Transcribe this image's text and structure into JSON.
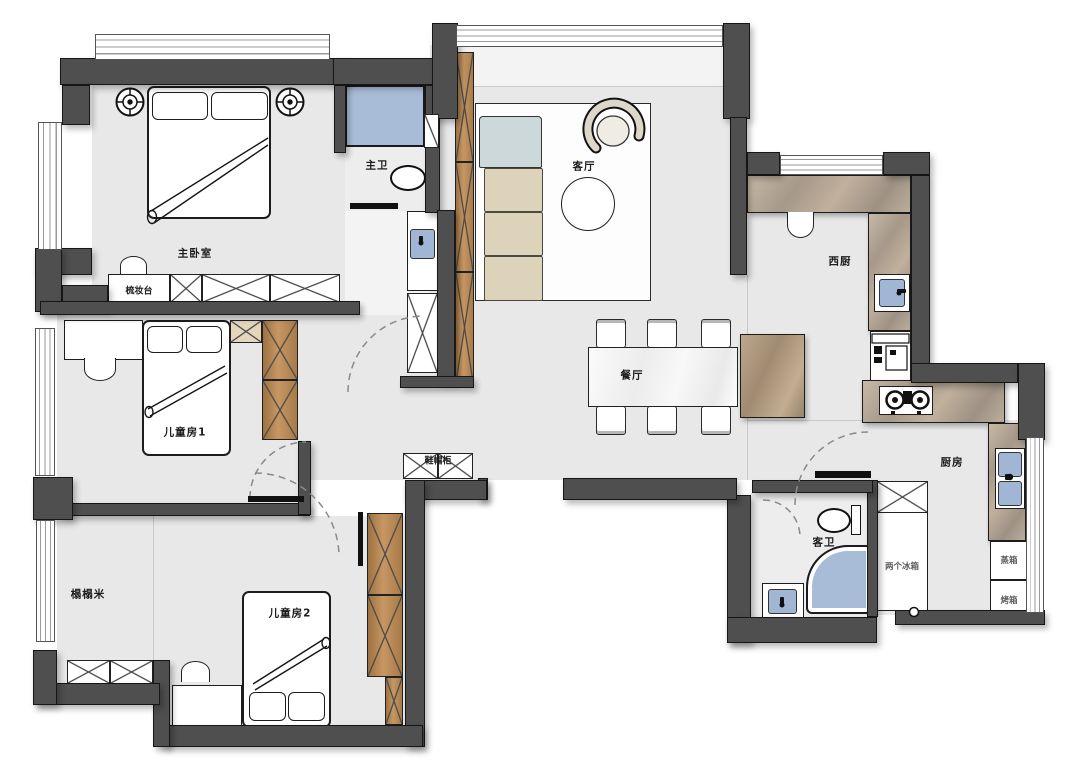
{
  "rooms": {
    "master_bedroom": "主卧室",
    "master_bath": "主卫",
    "living_room": "客厅",
    "west_kitchen": "西厨",
    "dining_room": "餐厅",
    "kids_room_1": "儿童房1",
    "kids_room_2": "儿童房2",
    "tatami": "榻榻米",
    "guest_bath": "客卫",
    "kitchen": "厨房"
  },
  "fixtures": {
    "dressing_table": "梳妆台",
    "shoe_cabinet": "鞋帽柜",
    "two_fridges": "两个冰箱",
    "steam_oven": "蒸箱",
    "oven": "烤箱"
  },
  "colors": {
    "wall": "#4f4f4f",
    "floor": "#e8e8e8",
    "water_blue": "#a8bcd8",
    "wood_brown": "#b5854f",
    "marble_tan": "#b3a492",
    "white_marble": "#f2f2f2",
    "sofa_beige": "#ddd3bb",
    "sofa_corner_blue": "#ccd8da"
  }
}
